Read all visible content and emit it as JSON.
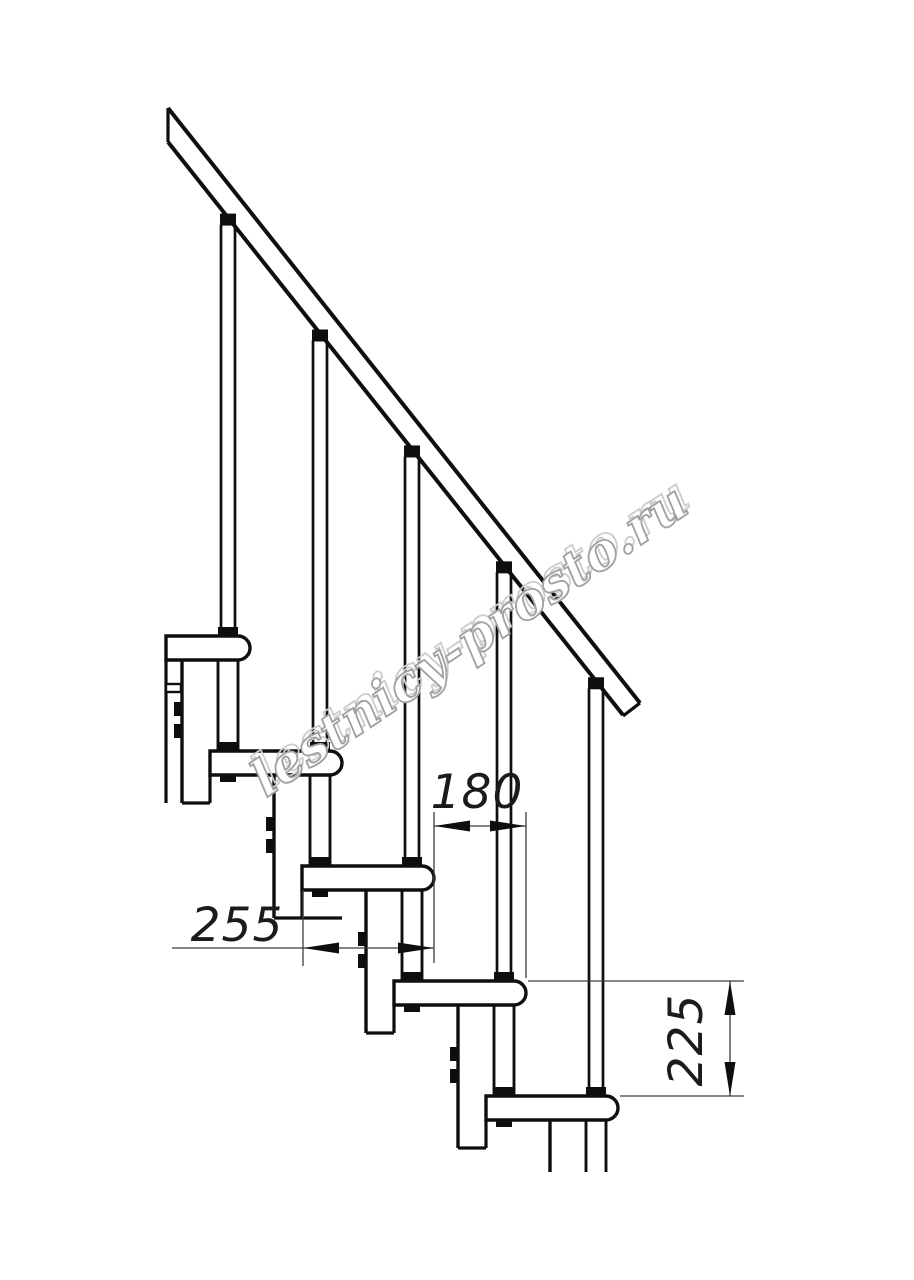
{
  "canvas": {
    "width": 914,
    "height": 1280,
    "background": "#ffffff"
  },
  "drawing": {
    "type": "modular-staircase-side-elevation",
    "ink_color": "#0e0e0e",
    "modules": 5,
    "balusters": 5,
    "handrail": true
  },
  "dimensions": {
    "going": {
      "value": "180"
    },
    "tread_depth": {
      "value": "255"
    },
    "rise": {
      "value": "225"
    },
    "color": "#3d3d3d"
  },
  "watermark": {
    "text": "lestnicy-prosto.ru",
    "outline_color": "#a0a0a0",
    "emboss_color": "#cccccc"
  }
}
